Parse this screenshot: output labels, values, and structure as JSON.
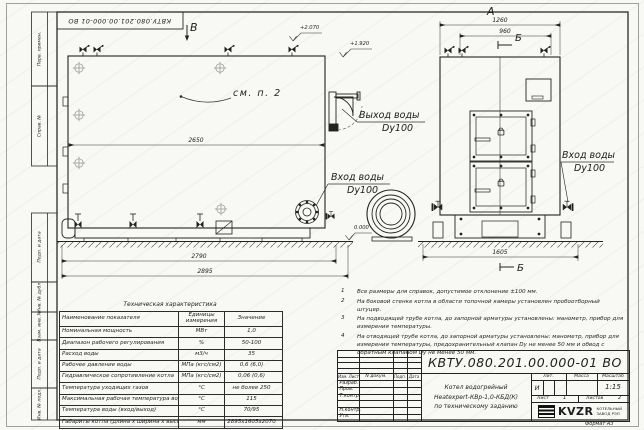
{
  "frame": {
    "stamp": "КВТУ.080.201.00.000-01 ВО",
    "format": "Формат А3",
    "margin_labels": [
      "Перв. примен.",
      "Справ. №",
      "Подп. и дата",
      "Инв. № дубл.",
      "Взам. инв. №",
      "Подп. и дата",
      "Инв. № подл."
    ]
  },
  "annotations": {
    "view_b": "В",
    "view_a": "А",
    "section_b_top": "Б",
    "section_b_bottom": "Б",
    "see_item": "см. п. 2",
    "elev_top": "+2.070",
    "elev_outlet": "+1.920",
    "elev_zero": "0.000",
    "dim_2650": "2650",
    "dim_2790": "2790",
    "dim_2895": "2895",
    "dim_1260": "1260",
    "dim_960": "960",
    "dim_1605": "1605",
    "water_out_label": "Выход воды",
    "water_out_dn": "Dy100",
    "water_in_left_label": "Вход воды",
    "water_in_left_dn": "Dy100",
    "water_in_right_label": "Вход воды",
    "water_in_right_dn": "Dy100"
  },
  "notes": {
    "items": [
      {
        "num": "1",
        "text": "Все размеры для справок, допустимое отклонение ±100 мм."
      },
      {
        "num": "2",
        "text": "На боковой стенке котла в области топочной камеры установлен пробоотборный штуцер."
      },
      {
        "num": "3",
        "text": "На подводящей трубе котла, до запорной арматуры установлены: манометр, прибор для измерения температуры."
      },
      {
        "num": "4",
        "text": "На отводящей трубе котла, до запорной арматуры установлены: манометр, прибор для измерения температуры, предохранительный клапан Dу не менее 50 мм и обвод с обратным клапаном Dу не менее 50 мм."
      }
    ]
  },
  "tech_table": {
    "title": "Техническая характеристика",
    "headers": [
      "Наименование показателя",
      "Единицы измерения",
      "Значение"
    ],
    "rows": [
      [
        "Номинальная мощность",
        "МВт",
        "1,0"
      ],
      [
        "Диапазон рабочего регулирования",
        "%",
        "50-100"
      ],
      [
        "Расход воды",
        "м3/ч",
        "35"
      ],
      [
        "Рабочее давление воды",
        "МПа (кгс/см2)",
        "0,6 (6,0)"
      ],
      [
        "Гидравлическое сопротивление котла",
        "МПа (кгс/см2)",
        "0,06 (0,6)"
      ],
      [
        "Температура уходящих газов",
        "°С",
        "не более 250"
      ],
      [
        "Максимальная рабочая температура воды",
        "°С",
        "115"
      ],
      [
        "Температура воды (вход/выход)",
        "°С",
        "70/95"
      ],
      [
        "Габариты котла (длина х ширина х высота)",
        "мм",
        "2895х1605х2070"
      ]
    ]
  },
  "title_block": {
    "doc_number": "КВТУ.080.201.00.000-01 ВО",
    "col_izm": "Изм. Лист",
    "col_doc": "N докум.",
    "col_sign": "Подп.",
    "col_date": "Дата",
    "row_labels": [
      "Разраб.",
      "Пров.",
      "Т.контр.",
      "",
      "Н.контр.",
      "Утв."
    ],
    "description_lines": [
      "Котел водогрейный",
      "Heatexpert-КВр-1,0-КБД(К)",
      "по техническому заданию"
    ],
    "lit_header": "Лит.",
    "lit_value": "И",
    "mass_header": "Масса",
    "scale_header": "Масштаб",
    "scale_value": "1:15",
    "sheet_label": "Лист",
    "sheet_value": "1",
    "sheets_label": "Листов",
    "sheets_value": "2",
    "logo_text": "KVZR",
    "company_line1": "КОТЕЛЬНЫЙ",
    "company_line2": "ЗАВОД РЭП"
  }
}
